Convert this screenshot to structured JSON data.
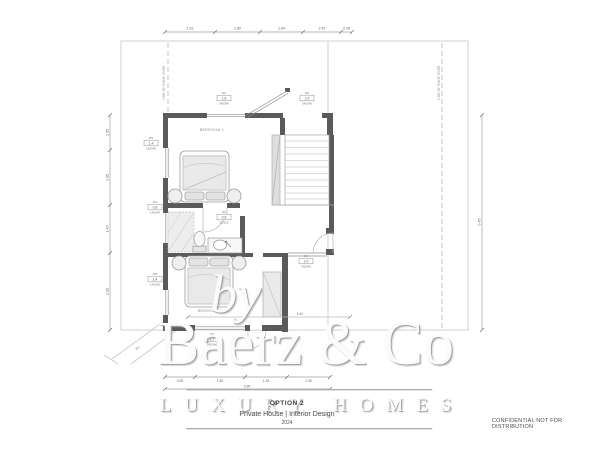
{
  "watermark": {
    "by_text": "by",
    "brand": "Baerz & Co",
    "tagline": "LUXURY HOMES"
  },
  "title_block": {
    "option_label": "OPTION 2",
    "project": "Private House | Interior Design",
    "year": "2024"
  },
  "footer": {
    "confidential": "CONFIDENTIAL NOT FOR DISTRIBUTION"
  },
  "plan": {
    "rooms": [
      {
        "label": "BEDROOM 1"
      },
      {
        "label": "BEDROOM 2"
      }
    ],
    "annotations": {
      "roof_line_left": "LINE OF ROOF OVER",
      "roof_line_right": "LINE OF ROOF OVER"
    },
    "dims": {
      "top": [
        "1.51",
        "1.80",
        "1.64",
        "2.42",
        "0.35"
      ],
      "left": [
        "1.05",
        "1.65",
        "1.45",
        "2.30"
      ],
      "bottom": [
        "0.90",
        "1.50",
        "1.25",
        "1.30"
      ],
      "bottom_total": "4.95",
      "right": "6.45",
      "interior": "6.40",
      "diagonal": "4.5"
    },
    "tags": [
      {
        "n": "W1",
        "s": "1.6",
        "d": "240/240"
      },
      {
        "n": "W2",
        "s": "2.0",
        "d": "240/240"
      },
      {
        "n": "W3",
        "s": "1.4",
        "d": "140/240"
      },
      {
        "n": "W4",
        "s": "0.8",
        "d": "140/240"
      },
      {
        "n": "W5",
        "s": "1.4",
        "d": "140/240"
      },
      {
        "n": "W6",
        "s": "1.7",
        "d": "240/140"
      },
      {
        "n": "D1",
        "s": "2.0",
        "d": "140/240"
      },
      {
        "n": "D2",
        "s": "0.8",
        "d": "82/210"
      }
    ]
  }
}
